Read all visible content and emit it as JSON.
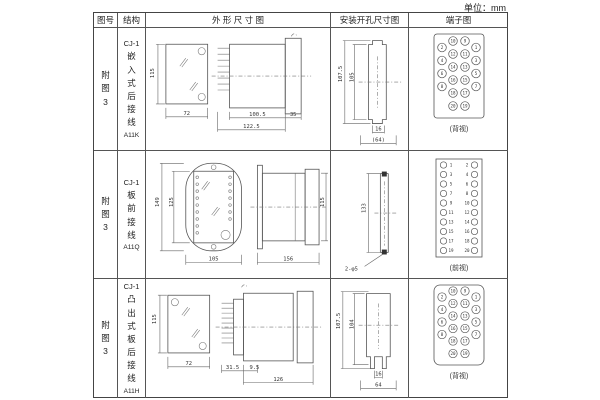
{
  "page": {
    "unit_label": "单位：mm"
  },
  "table": {
    "headers": {
      "fig_no": "图号",
      "structure": "结构",
      "outline": "外 形 尺 寸 图",
      "mounting": "安装开孔尺寸图",
      "terminal": "端子图"
    },
    "rows": [
      {
        "fig_no": "附图3",
        "structure": {
          "model": "CJ-1",
          "desc": "嵌入式后接线",
          "code": "A11K"
        },
        "outline": {
          "h": "115",
          "w": "72",
          "body": "100.5",
          "total": "122.5",
          "flange": "35"
        },
        "mounting": {
          "outer_h": "107.5",
          "inner_h": "105",
          "slot_w": "16",
          "width": "(64)"
        },
        "terminal": {
          "view": "(背视)"
        }
      },
      {
        "fig_no": "附图3",
        "structure": {
          "model": "CJ-1",
          "desc": "板前接线",
          "code": "A11Q"
        },
        "outline": {
          "plate_h": "149",
          "inner_h": "125",
          "w": "105",
          "len": "156",
          "h": "115"
        },
        "mounting": {
          "hole_span": "133",
          "holes": "2-φ5"
        },
        "terminal": {
          "view": "(前视)"
        }
      },
      {
        "fig_no": "附图3",
        "structure": {
          "model": "CJ-1",
          "desc": "凸出式板后接线",
          "code": "A11H"
        },
        "outline": {
          "h": "115",
          "w": "72",
          "pins": "31.5",
          "lip": "9.5",
          "len": "126"
        },
        "mounting": {
          "outer_h": "107.5",
          "inner_h": "104",
          "slot_w": "16",
          "width": "64"
        },
        "terminal": {
          "view": "(背视)"
        }
      }
    ]
  },
  "terminals": {
    "staggered_back_view": {
      "inner_left": [
        10,
        12,
        14,
        16,
        18,
        20
      ],
      "inner_right": [
        9,
        11,
        13,
        15,
        17,
        19
      ],
      "outer_left": [
        2,
        4,
        6,
        8
      ],
      "outer_right": [
        1,
        3,
        5,
        7
      ]
    },
    "dual_column_front_view": {
      "left": [
        1,
        3,
        5,
        7,
        9,
        11,
        13,
        15,
        17,
        19
      ],
      "right": [
        2,
        4,
        6,
        8,
        10,
        12,
        14,
        16,
        18,
        20
      ]
    }
  }
}
